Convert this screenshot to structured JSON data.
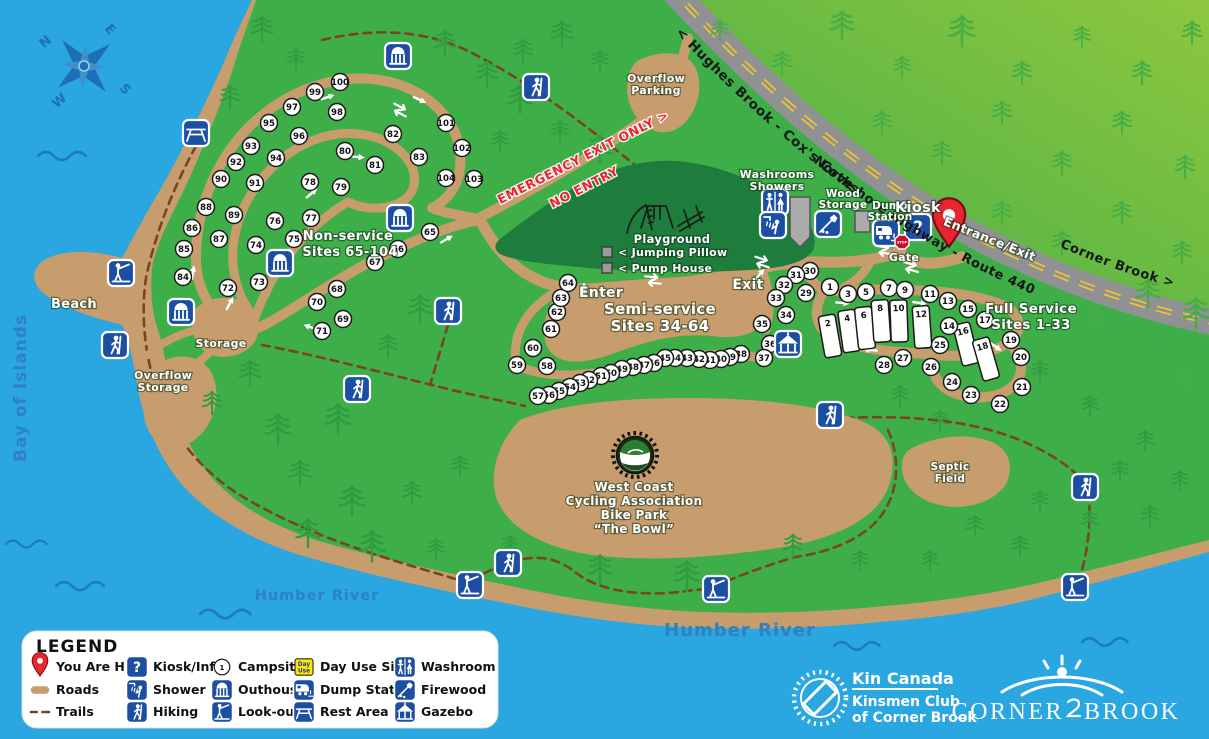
{
  "colors": {
    "water": "#2AA6E0",
    "land": "#3EAE49",
    "sand": "#C79D6E",
    "playground": "#1E7C3C",
    "trail": "#7A4423",
    "highway": "#8F9193",
    "highway_line": "#F2C430",
    "icon": "#1C4FA3",
    "red": "#E92530"
  },
  "compass": {
    "n": "N",
    "e": "E",
    "s": "S",
    "w": "W"
  },
  "water_labels": {
    "bay": "Bay of Islands",
    "river": "Humber River",
    "river2": "Humber River"
  },
  "highway_labels": {
    "west": "< Hughes Brook - Cox's Cove",
    "name": "Northshore Highway - Route 440",
    "east": "Corner Brook >"
  },
  "labels": {
    "overflow_parking": [
      "Overflow",
      "Parking"
    ],
    "washrooms": [
      "Washrooms",
      "Showers"
    ],
    "wood_storage": [
      "Wood",
      "Storage"
    ],
    "dump_station": [
      "Dump",
      "Station"
    ],
    "kiosk": "Kiosk",
    "gate": "Gate",
    "entrance": "Entrance/Exit",
    "stop": "STOP",
    "enter": "Enter",
    "exit": "Exit",
    "emergency": "EMERGENCY EXIT ONLY >",
    "no_entry": "NO ENTRY",
    "playground": "Playground",
    "jumping_pillow": "< Jumping Pillow",
    "pump_house": "< Pump House",
    "beach": "Beach",
    "storage": "Storage",
    "overflow_storage": [
      "Overflow",
      "Storage"
    ],
    "septic": [
      "Septic",
      "Field"
    ],
    "bike_park": [
      "West Coast",
      "Cycling Association",
      "Bike Park",
      "“The Bowl”"
    ],
    "non_service": [
      "Non-service",
      "Sites 65-104"
    ],
    "semi_service": [
      "Semi-service",
      "Sites 34-64"
    ],
    "full_service": [
      "Full Service",
      "Sites 1-33"
    ]
  },
  "legend": {
    "title": "LEGEND",
    "campsite_number": "1",
    "day_use": [
      "Day",
      "Use"
    ],
    "kiosk_glyph": "?",
    "items": [
      {
        "t": "pin",
        "label": "You Are Here"
      },
      {
        "t": "kiosk",
        "label": "Kiosk/Info"
      },
      {
        "t": "campsite",
        "label": "Campsites"
      },
      {
        "t": "day-use",
        "label": "Day Use Site"
      },
      {
        "t": "washroom",
        "label": "Washroom"
      },
      {
        "t": "roads",
        "label": "Roads"
      },
      {
        "t": "shower",
        "label": "Shower"
      },
      {
        "t": "outhouse",
        "label": "Outhouse"
      },
      {
        "t": "dump",
        "label": "Dump Station"
      },
      {
        "t": "firewood",
        "label": "Firewood"
      },
      {
        "t": "trails",
        "label": "Trails"
      },
      {
        "t": "hiking",
        "label": "Hiking"
      },
      {
        "t": "lookout",
        "label": "Look-out"
      },
      {
        "t": "rest-area",
        "label": "Rest Area"
      },
      {
        "t": "gazebo",
        "label": "Gazebo"
      }
    ]
  },
  "branding": {
    "kin": [
      "Kin Canada",
      "Kinsmen Club",
      "of Corner Brook"
    ],
    "city": [
      "CORNER",
      "BROOK"
    ]
  },
  "pin": {
    "x": 949,
    "y": 228
  },
  "sites": [
    {
      "n": 1,
      "x": 830,
      "y": 287
    },
    {
      "n": 3,
      "x": 848,
      "y": 294
    },
    {
      "n": 5,
      "x": 866,
      "y": 292
    },
    {
      "n": 7,
      "x": 889,
      "y": 288
    },
    {
      "n": 9,
      "x": 905,
      "y": 290
    },
    {
      "n": 11,
      "x": 930,
      "y": 294
    },
    {
      "n": 13,
      "x": 948,
      "y": 301
    },
    {
      "n": 14,
      "x": 949,
      "y": 326
    },
    {
      "n": 15,
      "x": 968,
      "y": 309
    },
    {
      "n": 17,
      "x": 985,
      "y": 320
    },
    {
      "n": 19,
      "x": 1011,
      "y": 340
    },
    {
      "n": 20,
      "x": 1021,
      "y": 357
    },
    {
      "n": 21,
      "x": 1022,
      "y": 387
    },
    {
      "n": 22,
      "x": 1000,
      "y": 404
    },
    {
      "n": 23,
      "x": 971,
      "y": 395
    },
    {
      "n": 24,
      "x": 952,
      "y": 382
    },
    {
      "n": 25,
      "x": 940,
      "y": 345
    },
    {
      "n": 26,
      "x": 931,
      "y": 367
    },
    {
      "n": 27,
      "x": 903,
      "y": 358
    },
    {
      "n": 28,
      "x": 884,
      "y": 365
    },
    {
      "n": 29,
      "x": 806,
      "y": 293
    },
    {
      "n": 30,
      "x": 810,
      "y": 271
    },
    {
      "n": 31,
      "x": 796,
      "y": 275
    },
    {
      "n": 32,
      "x": 784,
      "y": 285
    },
    {
      "n": 33,
      "x": 776,
      "y": 298
    },
    {
      "n": 34,
      "x": 786,
      "y": 315
    },
    {
      "n": 35,
      "x": 762,
      "y": 324
    },
    {
      "n": 36,
      "x": 770,
      "y": 344
    },
    {
      "n": 37,
      "x": 764,
      "y": 358
    },
    {
      "n": 38,
      "x": 741,
      "y": 354
    },
    {
      "n": 39,
      "x": 730,
      "y": 357
    },
    {
      "n": 40,
      "x": 721,
      "y": 359
    },
    {
      "n": 41,
      "x": 710,
      "y": 360
    },
    {
      "n": 42,
      "x": 699,
      "y": 359
    },
    {
      "n": 43,
      "x": 687,
      "y": 358
    },
    {
      "n": 44,
      "x": 675,
      "y": 358
    },
    {
      "n": 45,
      "x": 665,
      "y": 358
    },
    {
      "n": 46,
      "x": 654,
      "y": 363
    },
    {
      "n": 47,
      "x": 644,
      "y": 365
    },
    {
      "n": 48,
      "x": 633,
      "y": 367
    },
    {
      "n": 49,
      "x": 622,
      "y": 369
    },
    {
      "n": 50,
      "x": 611,
      "y": 373
    },
    {
      "n": 51,
      "x": 601,
      "y": 376
    },
    {
      "n": 52,
      "x": 589,
      "y": 380
    },
    {
      "n": 53,
      "x": 580,
      "y": 383
    },
    {
      "n": 54,
      "x": 570,
      "y": 387
    },
    {
      "n": 55,
      "x": 559,
      "y": 391
    },
    {
      "n": 56,
      "x": 549,
      "y": 395
    },
    {
      "n": 57,
      "x": 538,
      "y": 396
    },
    {
      "n": 58,
      "x": 547,
      "y": 366
    },
    {
      "n": 59,
      "x": 517,
      "y": 365
    },
    {
      "n": 60,
      "x": 533,
      "y": 348
    },
    {
      "n": 61,
      "x": 551,
      "y": 329
    },
    {
      "n": 62,
      "x": 557,
      "y": 312
    },
    {
      "n": 63,
      "x": 561,
      "y": 298
    },
    {
      "n": 64,
      "x": 568,
      "y": 283
    },
    {
      "n": 65,
      "x": 430,
      "y": 232
    },
    {
      "n": 66,
      "x": 398,
      "y": 249
    },
    {
      "n": 67,
      "x": 375,
      "y": 262
    },
    {
      "n": 68,
      "x": 337,
      "y": 289
    },
    {
      "n": 69,
      "x": 343,
      "y": 319
    },
    {
      "n": 70,
      "x": 317,
      "y": 302
    },
    {
      "n": 71,
      "x": 322,
      "y": 331
    },
    {
      "n": 72,
      "x": 228,
      "y": 288
    },
    {
      "n": 73,
      "x": 259,
      "y": 282
    },
    {
      "n": 74,
      "x": 256,
      "y": 245
    },
    {
      "n": 75,
      "x": 294,
      "y": 239
    },
    {
      "n": 76,
      "x": 275,
      "y": 221
    },
    {
      "n": 77,
      "x": 311,
      "y": 218
    },
    {
      "n": 78,
      "x": 310,
      "y": 182
    },
    {
      "n": 79,
      "x": 341,
      "y": 187
    },
    {
      "n": 80,
      "x": 345,
      "y": 151
    },
    {
      "n": 81,
      "x": 375,
      "y": 165
    },
    {
      "n": 82,
      "x": 393,
      "y": 134
    },
    {
      "n": 83,
      "x": 419,
      "y": 157
    },
    {
      "n": 84,
      "x": 183,
      "y": 277
    },
    {
      "n": 85,
      "x": 184,
      "y": 249
    },
    {
      "n": 86,
      "x": 192,
      "y": 228
    },
    {
      "n": 87,
      "x": 219,
      "y": 239
    },
    {
      "n": 88,
      "x": 206,
      "y": 207
    },
    {
      "n": 89,
      "x": 234,
      "y": 215
    },
    {
      "n": 90,
      "x": 221,
      "y": 179
    },
    {
      "n": 91,
      "x": 255,
      "y": 183
    },
    {
      "n": 92,
      "x": 236,
      "y": 162
    },
    {
      "n": 93,
      "x": 251,
      "y": 146
    },
    {
      "n": 94,
      "x": 276,
      "y": 158
    },
    {
      "n": 95,
      "x": 269,
      "y": 123
    },
    {
      "n": 96,
      "x": 299,
      "y": 136
    },
    {
      "n": 97,
      "x": 292,
      "y": 107
    },
    {
      "n": 98,
      "x": 337,
      "y": 112
    },
    {
      "n": 99,
      "x": 315,
      "y": 92
    },
    {
      "n": 100,
      "x": 340,
      "y": 82
    },
    {
      "n": 101,
      "x": 446,
      "y": 123
    },
    {
      "n": 102,
      "x": 462,
      "y": 148
    },
    {
      "n": 103,
      "x": 474,
      "y": 179
    },
    {
      "n": 104,
      "x": 446,
      "y": 178
    }
  ],
  "pads": [
    {
      "n": 2,
      "x": 830,
      "y": 336,
      "r": -10
    },
    {
      "n": 4,
      "x": 849,
      "y": 331,
      "r": -8
    },
    {
      "n": 6,
      "x": 865,
      "y": 328,
      "r": -6
    },
    {
      "n": 8,
      "x": 881,
      "y": 321,
      "r": -4
    },
    {
      "n": 10,
      "x": 899,
      "y": 321,
      "r": -2
    },
    {
      "n": 12,
      "x": 922,
      "y": 327,
      "r": -4
    },
    {
      "n": 16,
      "x": 966,
      "y": 344,
      "r": -14
    },
    {
      "n": 18,
      "x": 986,
      "y": 359,
      "r": -16
    }
  ],
  "map_icons": [
    {
      "t": "rest-area",
      "x": 196,
      "y": 133
    },
    {
      "t": "outhouse",
      "x": 398,
      "y": 56
    },
    {
      "t": "hiking",
      "x": 536,
      "y": 87
    },
    {
      "t": "outhouse",
      "x": 400,
      "y": 218
    },
    {
      "t": "outhouse",
      "x": 280,
      "y": 263
    },
    {
      "t": "outhouse",
      "x": 181,
      "y": 312
    },
    {
      "t": "lookout",
      "x": 121,
      "y": 273
    },
    {
      "t": "hiking",
      "x": 115,
      "y": 345
    },
    {
      "t": "hiking",
      "x": 448,
      "y": 311
    },
    {
      "t": "hiking",
      "x": 357,
      "y": 389
    },
    {
      "t": "washroom",
      "x": 775,
      "y": 202
    },
    {
      "t": "shower",
      "x": 773,
      "y": 225
    },
    {
      "t": "firewood",
      "x": 828,
      "y": 224
    },
    {
      "t": "dump",
      "x": 886,
      "y": 233
    },
    {
      "t": "kiosk",
      "x": 918,
      "y": 227
    },
    {
      "t": "gazebo",
      "x": 788,
      "y": 344
    },
    {
      "t": "hiking",
      "x": 830,
      "y": 415
    },
    {
      "t": "hiking",
      "x": 508,
      "y": 563
    },
    {
      "t": "lookout",
      "x": 470,
      "y": 585
    },
    {
      "t": "lookout",
      "x": 716,
      "y": 589
    },
    {
      "t": "hiking",
      "x": 1085,
      "y": 487
    },
    {
      "t": "lookout",
      "x": 1075,
      "y": 587
    }
  ],
  "road_arrows": [
    [
      328,
      97,
      -18
    ],
    [
      420,
      100,
      25
    ],
    [
      358,
      157,
      5
    ],
    [
      312,
      193,
      -40
    ],
    [
      193,
      272,
      -82
    ],
    [
      230,
      303,
      -62
    ],
    [
      310,
      327,
      200
    ],
    [
      447,
      239,
      -30
    ],
    [
      584,
      291,
      90
    ],
    [
      760,
      274,
      -50
    ],
    [
      870,
      350,
      185
    ],
    [
      996,
      347,
      35
    ],
    [
      920,
      303,
      8
    ],
    [
      843,
      303,
      5
    ]
  ],
  "junction_arrows": [
    [
      653,
      280,
      5
    ],
    [
      762,
      262,
      18
    ],
    [
      884,
      250,
      8
    ],
    [
      911,
      267,
      15
    ],
    [
      400,
      110,
      28
    ]
  ],
  "trees": {
    "dark": [
      [
        262,
        28
      ],
      [
        296,
        58
      ],
      [
        230,
        96
      ],
      [
        445,
        42
      ],
      [
        487,
        73
      ],
      [
        523,
        50
      ],
      [
        562,
        33
      ],
      [
        600,
        60
      ],
      [
        520,
        98
      ],
      [
        560,
        130
      ],
      [
        600,
        148
      ],
      [
        500,
        140
      ],
      [
        420,
        308
      ],
      [
        388,
        345
      ],
      [
        250,
        372
      ],
      [
        212,
        402
      ],
      [
        278,
        428
      ],
      [
        338,
        418
      ],
      [
        300,
        472
      ],
      [
        352,
        500
      ],
      [
        412,
        492
      ],
      [
        308,
        532
      ],
      [
        372,
        545
      ],
      [
        436,
        548
      ],
      [
        460,
        465
      ],
      [
        510,
        545
      ],
      [
        600,
        568
      ],
      [
        687,
        575
      ],
      [
        793,
        545
      ],
      [
        860,
        560
      ],
      [
        930,
        560
      ],
      [
        1040,
        370
      ],
      [
        1090,
        405
      ],
      [
        1145,
        440
      ],
      [
        1180,
        480
      ],
      [
        1120,
        470
      ],
      [
        1040,
        500
      ],
      [
        1090,
        520
      ],
      [
        1150,
        515
      ],
      [
        900,
        395
      ],
      [
        940,
        420
      ],
      [
        975,
        525
      ],
      [
        1020,
        545
      ]
    ],
    "light": [
      [
        720,
        30
      ],
      [
        782,
        62
      ],
      [
        842,
        24
      ],
      [
        902,
        66
      ],
      [
        962,
        30
      ],
      [
        1022,
        72
      ],
      [
        1082,
        36
      ],
      [
        1142,
        72
      ],
      [
        1192,
        32
      ],
      [
        882,
        122
      ],
      [
        942,
        152
      ],
      [
        1002,
        112
      ],
      [
        1062,
        162
      ],
      [
        1122,
        122
      ],
      [
        1185,
        166
      ],
      [
        1002,
        212
      ],
      [
        1062,
        242
      ],
      [
        1122,
        212
      ],
      [
        1182,
        252
      ],
      [
        1196,
        312
      ],
      [
        1148,
        292
      ],
      [
        1096,
        318
      ],
      [
        1185,
        380
      ]
    ]
  },
  "waves": [
    [
      38,
      156,
      1
    ],
    [
      6,
      544,
      0.85
    ],
    [
      56,
      586,
      1
    ],
    [
      200,
      614,
      1.05
    ],
    [
      834,
      646,
      0.95
    ],
    [
      1082,
      642,
      0.95
    ]
  ]
}
